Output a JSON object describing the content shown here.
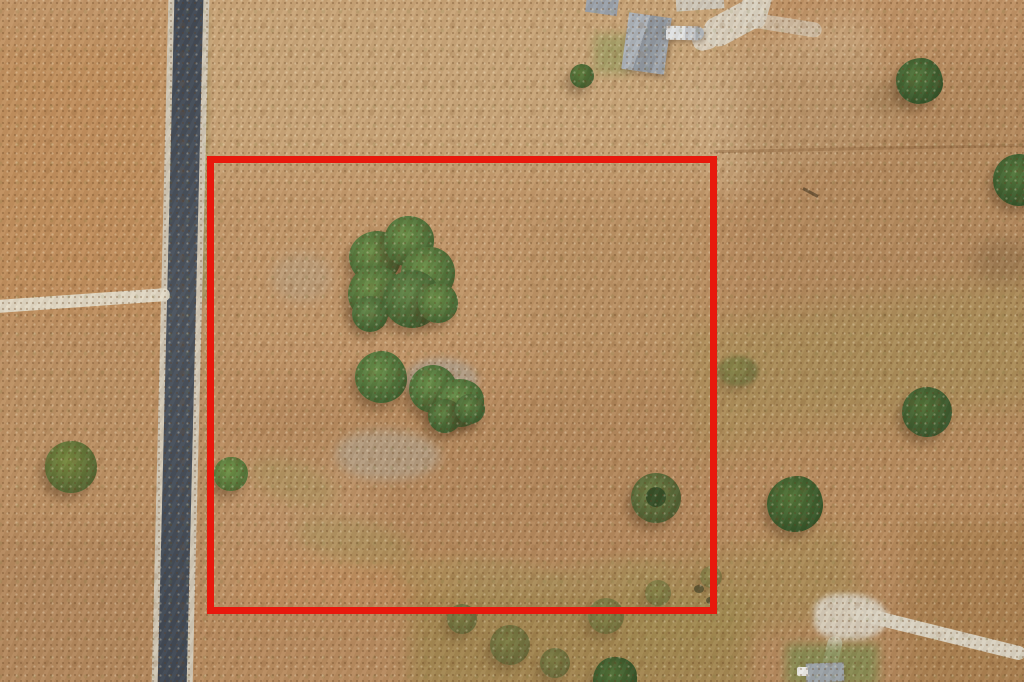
{
  "meta": {
    "type": "aerial-drone-photo",
    "subject": "vacant rural land parcel outlined with red property boundary, paved road on left, homestead with buildings at top, scattered trees and gravel drives"
  },
  "colors": {
    "boundary_red": "#e8190d",
    "road_asphalt": "#47505c",
    "road_shoulder": "#cfc6b5",
    "gravel": "#d9d2c2",
    "ground_tan": "#bc9065",
    "tree_green": "#4e7036",
    "roof_gray": "#99a1ab",
    "rv_white": "#dfe2e4"
  },
  "scene": {
    "layers": [
      {
        "n": "ground-patch-top-light",
        "x": 180,
        "y": -20,
        "w": 560,
        "h": 200,
        "c": "#cbaa7e",
        "op": 0.8,
        "bl": 22
      },
      {
        "n": "ground-patch-topright-mowed",
        "x": 690,
        "y": 40,
        "w": 200,
        "h": 130,
        "c": "#cdad85",
        "op": 0.75,
        "bl": 14,
        "rot": -20
      },
      {
        "n": "ground-patch-topleft-orange",
        "x": -20,
        "y": 40,
        "w": 190,
        "h": 280,
        "c": "#c08a54",
        "op": 0.5,
        "bl": 20
      },
      {
        "n": "ground-patch-left-mid",
        "x": -20,
        "y": 330,
        "w": 190,
        "h": 200,
        "c": "#bb9265",
        "op": 0.5,
        "bl": 20
      },
      {
        "n": "ground-patch-left-bottom",
        "x": -20,
        "y": 530,
        "w": 200,
        "h": 170,
        "c": "#ad835a",
        "op": 0.55,
        "bl": 18
      },
      {
        "n": "ground-patch-parcel-upper",
        "x": 220,
        "y": 165,
        "w": 490,
        "h": 210,
        "c": "#c49b6e",
        "op": 0.6,
        "bl": 22
      },
      {
        "n": "ground-patch-parcel-right-dark",
        "x": 530,
        "y": 200,
        "w": 190,
        "h": 230,
        "c": "#b18a5c",
        "op": 0.45,
        "bl": 24
      },
      {
        "n": "ground-patch-parcel-lower",
        "x": 235,
        "y": 395,
        "w": 470,
        "h": 215,
        "c": "#b0855a",
        "op": 0.5,
        "bl": 22
      },
      {
        "n": "ground-patch-parcel-left-light",
        "x": 222,
        "y": 455,
        "w": 150,
        "h": 150,
        "c": "#c59c72",
        "op": 0.5,
        "bl": 18
      },
      {
        "n": "ground-patch-parcel-bottom-orange",
        "x": 240,
        "y": 555,
        "w": 220,
        "h": 60,
        "c": "#c18a57",
        "op": 0.45,
        "bl": 12
      },
      {
        "n": "ground-patch-right-brushy",
        "x": 740,
        "y": 60,
        "w": 300,
        "h": 420,
        "c": "#ad855a",
        "op": 0.55,
        "bl": 20
      },
      {
        "n": "ground-patch-right-green-band",
        "x": 690,
        "y": 300,
        "w": 360,
        "h": 130,
        "c": "#a39156",
        "op": 0.5,
        "bl": 16,
        "rot": -9
      },
      {
        "n": "ground-patch-right-lower",
        "x": 750,
        "y": 420,
        "w": 290,
        "h": 160,
        "c": "#ba8e60",
        "op": 0.5,
        "bl": 20
      },
      {
        "n": "ground-patch-scrub-band",
        "x": 410,
        "y": 592,
        "w": 340,
        "h": 100,
        "c": "#968549",
        "op": 0.6,
        "bl": 10
      },
      {
        "n": "ground-patch-scrub-upright",
        "x": 620,
        "y": 548,
        "w": 240,
        "h": 90,
        "c": "#a08c52",
        "op": 0.5,
        "bl": 12,
        "rot": -12
      },
      {
        "n": "ground-patch-bottomright-brushy",
        "x": 905,
        "y": 520,
        "w": 140,
        "h": 180,
        "c": "#a37a49",
        "op": 0.6,
        "bl": 12
      },
      {
        "n": "rocky-patch",
        "x": 336,
        "y": 430,
        "w": 104,
        "h": 50,
        "c": "#b2a591",
        "op": 0.65,
        "bl": 5,
        "r": "45% 55% 50% 50%"
      },
      {
        "n": "rocky-patch",
        "x": 404,
        "y": 358,
        "w": 74,
        "h": 44,
        "c": "#aba294",
        "op": 0.7,
        "bl": 4,
        "r": "50%"
      },
      {
        "n": "rocky-patch",
        "x": 272,
        "y": 252,
        "w": 60,
        "h": 50,
        "c": "#b4a68e",
        "op": 0.4,
        "bl": 6,
        "r": "50%"
      },
      {
        "n": "swale-patch",
        "x": 248,
        "y": 462,
        "w": 90,
        "h": 40,
        "c": "#9f9358",
        "op": 0.4,
        "bl": 7,
        "rot": 20,
        "r": "50%"
      },
      {
        "n": "swale-patch",
        "x": 295,
        "y": 520,
        "w": 120,
        "h": 44,
        "c": "#9f9358",
        "op": 0.4,
        "bl": 7,
        "rot": 12,
        "r": "50%"
      },
      {
        "n": "swale-patch",
        "x": 395,
        "y": 558,
        "w": 170,
        "h": 40,
        "c": "#9f9358",
        "op": 0.4,
        "bl": 7,
        "rot": 3,
        "r": "50%"
      },
      {
        "n": "swale-patch",
        "x": 545,
        "y": 560,
        "w": 130,
        "h": 34,
        "c": "#9f9358",
        "op": 0.35,
        "bl": 7,
        "rot": -6,
        "r": "50%"
      },
      {
        "n": "roadside-grass-strip",
        "x": 196,
        "y": 10,
        "w": 12,
        "h": 290,
        "c": "#8d8d52",
        "op": 0.5,
        "bl": 3
      },
      {
        "n": "fence-line",
        "x": 714,
        "y": 147,
        "w": 310,
        "h": 3,
        "c": "rgba(145,105,65,0.5)",
        "rot": -1.2
      },
      {
        "n": "paved-road-shoulder",
        "x": 160,
        "y": -10,
        "w": 41,
        "h": 705,
        "c": "#cfc6b5",
        "rot": 1.4
      },
      {
        "n": "paved-road-asphalt",
        "x": 166,
        "y": -10,
        "w": 29,
        "h": 705,
        "bg": "linear-gradient(180deg,#3e4754,#49525e 45%,#3d4653)",
        "rot": 1.4
      },
      {
        "n": "gravel-driveway-left",
        "x": -6,
        "y": 294,
        "w": 176,
        "h": 13,
        "c": "#e2dbc9",
        "rot": -4,
        "r": 6,
        "op": 0.95
      },
      {
        "n": "gravel-driveway-top",
        "x": 741,
        "y": -12,
        "w": 28,
        "h": 40,
        "c": "#d9d2c2",
        "rot": 16,
        "r": 10,
        "op": 0.95
      },
      {
        "n": "gravel-driveway-top",
        "x": 702,
        "y": 8,
        "w": 64,
        "h": 30,
        "c": "#d9d2c2",
        "rot": -28,
        "r": 14,
        "op": 0.95
      },
      {
        "n": "gravel-driveway-top",
        "x": 692,
        "y": 28,
        "w": 26,
        "h": 22,
        "c": "#d9d2c2",
        "rot": -15,
        "r": 10,
        "op": 0.9
      },
      {
        "n": "gravel-driveway-top",
        "x": 752,
        "y": 18,
        "w": 70,
        "h": 15,
        "c": "#d4cdbd",
        "rot": 9,
        "r": 8,
        "op": 0.65
      },
      {
        "n": "gravel-pad",
        "x": 814,
        "y": 594,
        "w": 74,
        "h": 46,
        "c": "#d6cebe",
        "r": "40% 60% 55% 45%",
        "bl": 3,
        "op": 0.95
      },
      {
        "n": "gravel-road-bottomright",
        "x": 848,
        "y": 626,
        "w": 180,
        "h": 14,
        "c": "#d9d2c2",
        "rot": 13.9,
        "r": 7
      },
      {
        "n": "gravel-spur-bottom",
        "x": 824,
        "y": 636,
        "w": 15,
        "h": 42,
        "c": "#d8d1c1",
        "rot": 14,
        "r": 7,
        "op": 0.85
      },
      {
        "n": "lawn-patch-bottom",
        "x": 786,
        "y": 644,
        "w": 92,
        "h": 42,
        "c": "#7d8b50",
        "bl": 5,
        "op": 0.8
      },
      {
        "n": "shed-roof",
        "x": 806,
        "y": 663,
        "w": 38,
        "h": 19,
        "c": "#9aa2a8",
        "rot": -2,
        "sh": "1px 2px 4px rgba(70,50,30,.4)"
      },
      {
        "n": "vehicle-white",
        "x": 797,
        "y": 667,
        "w": 11,
        "h": 9,
        "c": "#e9e9e6",
        "r": 2
      },
      {
        "n": "lawn-patch-top",
        "x": 594,
        "y": 34,
        "w": 36,
        "h": 40,
        "c": "#8e9a5c",
        "bl": 5,
        "op": 0.6
      },
      {
        "n": "building-roof-small",
        "x": 586,
        "y": -4,
        "w": 32,
        "h": 18,
        "c": "#99a1ab",
        "rot": 8
      },
      {
        "n": "building-roof-partial",
        "x": 676,
        "y": -4,
        "w": 48,
        "h": 14,
        "c": "#cdc7ba",
        "rot": -4
      },
      {
        "n": "building-roof-main",
        "x": 625,
        "y": 15,
        "w": 43,
        "h": 57,
        "bg": "linear-gradient(100deg,#aab1ba 0 40%,#8e96a0 40% 75%,#9ba3ad 75%)",
        "rot": 8,
        "sh": "2px 3px 6px rgba(80,60,40,.4)"
      },
      {
        "n": "rv-trailer",
        "x": 662,
        "y": 26,
        "w": 42,
        "h": 14,
        "bg": "linear-gradient(90deg,#868d94 0 10%,#dfe2e4 10% 55%,#c6cacf 55% 80%,#aab0b6 80%)",
        "rot": 1,
        "r": 7,
        "sh": "1px 2px 4px rgba(80,60,40,.4)"
      },
      {
        "n": "tree-shadow",
        "x": 864,
        "y": 84,
        "w": 46,
        "h": 30,
        "c": "#96754e",
        "op": 0.5,
        "bl": 7,
        "r": "50%"
      },
      {
        "n": "tree-shadow",
        "x": 972,
        "y": 238,
        "w": 60,
        "h": 46,
        "c": "#8a6c48",
        "op": 0.5,
        "bl": 8,
        "r": "50%"
      },
      {
        "n": "tree-canopy",
        "x": 896,
        "y": 58,
        "w": 47,
        "h": 46,
        "c1": "#52773c",
        "c2": "#2f4e26",
        "r": "55% 45% 52% 48%/48% 55% 45% 52%"
      },
      {
        "n": "tree-canopy",
        "x": 993,
        "y": 154,
        "w": 52,
        "h": 52,
        "c1": "#52773c",
        "c2": "#2f4e26",
        "r": "50%"
      },
      {
        "n": "fallen-branch",
        "x": 802,
        "y": 191,
        "w": 17,
        "h": 3,
        "c": "#6d5537",
        "rot": 28
      },
      {
        "n": "tree-canopy-cluster",
        "x": 349,
        "y": 231,
        "w": 52,
        "c1": "#6b9049",
        "c2": "#3f6030",
        "r": "55% 45% 50% 50%/50% 52% 48% 50%"
      },
      {
        "n": "tree-canopy-cluster",
        "x": 384,
        "y": 216,
        "w": 50,
        "c1": "#6b9049",
        "c2": "#3f6030",
        "r": "48% 52% 55% 45%/52% 48% 50% 50%"
      },
      {
        "n": "tree-canopy-cluster",
        "x": 401,
        "y": 247,
        "w": 54,
        "c1": "#6b9049",
        "c2": "#3f6030",
        "r": "52% 48% 45% 55%/50% 50% 55% 45%"
      },
      {
        "n": "tree-canopy-cluster",
        "x": 348,
        "y": 266,
        "w": 54,
        "c1": "#6b9049",
        "c2": "#3f6030",
        "r": "50% 50% 52% 48%/55% 45% 50% 50%"
      },
      {
        "n": "tree-canopy-cluster",
        "x": 383,
        "y": 270,
        "w": 58,
        "c1": "#63884a",
        "c2": "#3a5a2c",
        "r": "50%"
      },
      {
        "n": "tree-canopy-cluster",
        "x": 418,
        "y": 283,
        "w": 40,
        "c1": "#6b9049",
        "c2": "#3f6030",
        "r": "55% 45% 50% 50%/48% 52% 50% 50%"
      },
      {
        "n": "tree-canopy-cluster",
        "x": 352,
        "y": 296,
        "w": 36,
        "c1": "#63884a",
        "c2": "#3a5a2c",
        "r": "50%"
      },
      {
        "n": "tree-canopy-cluster",
        "x": 355,
        "y": 351,
        "w": 52,
        "c1": "#68904a",
        "c2": "#3c5e2e",
        "r": "52% 48% 50% 50%/50% 55% 45% 50%"
      },
      {
        "n": "tree-canopy-cluster",
        "x": 409,
        "y": 365,
        "w": 48,
        "c1": "#68904a",
        "c2": "#3c5e2e",
        "r": "50%"
      },
      {
        "n": "tree-canopy-cluster",
        "x": 436,
        "y": 379,
        "w": 48,
        "c1": "#68904a",
        "c2": "#3c5e2e",
        "r": "48% 52% 50% 50%/55% 45% 52% 48%"
      },
      {
        "n": "tree-canopy-cluster",
        "x": 428,
        "y": 399,
        "w": 34,
        "c1": "#5f8444",
        "c2": "#38572b",
        "r": "50%"
      },
      {
        "n": "tree-canopy-cluster",
        "x": 455,
        "y": 394,
        "w": 30,
        "c1": "#5f8444",
        "c2": "#38572b",
        "r": "50%"
      },
      {
        "n": "tree-canopy",
        "x": 214,
        "y": 457,
        "w": 34,
        "c1": "#6f9348",
        "c2": "#4a6a33",
        "r": "52% 48% 50% 50%/50% 50% 55% 45%"
      },
      {
        "n": "tree-canopy",
        "x": 631,
        "y": 473,
        "w": 50,
        "c1": "#6e7f45",
        "c2": "#47582e",
        "r": "50%"
      },
      {
        "n": "tree-canopy-center",
        "x": 646,
        "y": 487,
        "w": 20,
        "c": "#2e4823",
        "r": "50%",
        "op": 0.9
      },
      {
        "n": "tree-canopy",
        "x": 45,
        "y": 441,
        "w": 52,
        "c1": "#77893f",
        "c2": "#4f6130",
        "r": "52% 48% 50% 50%/48% 52% 50% 50%"
      },
      {
        "n": "tree-canopy",
        "x": 767,
        "y": 476,
        "w": 56,
        "c1": "#527538",
        "c2": "#2f4f26",
        "r": "55% 45% 50% 50%/50% 52% 48% 50%"
      },
      {
        "n": "tree-canopy",
        "x": 902,
        "y": 387,
        "w": 50,
        "c1": "#4f7036",
        "c2": "#33512a",
        "r": "50%"
      },
      {
        "n": "tree-canopy",
        "x": 593,
        "y": 657,
        "w": 44,
        "c1": "#4e6f36",
        "c2": "#2f4c25",
        "r": "50% 50% 45% 55%/55% 45% 50% 50%"
      },
      {
        "n": "bush-small",
        "x": 570,
        "y": 64,
        "w": 24,
        "c1": "#5c7c3c",
        "c2": "#3b5a2c",
        "r": "50%"
      },
      {
        "n": "scrub-blob",
        "x": 447,
        "y": 604,
        "w": 30,
        "c1": "#6e7b40",
        "c2": "#4c5a2e",
        "r": "50%",
        "op": 0.7
      },
      {
        "n": "scrub-blob",
        "x": 490,
        "y": 625,
        "w": 40,
        "c1": "#6e7b40",
        "c2": "#4c5a2e",
        "r": "50%",
        "op": 0.7
      },
      {
        "n": "scrub-blob",
        "x": 540,
        "y": 648,
        "w": 30,
        "c1": "#6e7b40",
        "c2": "#4c5a2e",
        "r": "50%",
        "op": 0.7
      },
      {
        "n": "scrub-blob",
        "x": 588,
        "y": 598,
        "w": 36,
        "c1": "#72813f",
        "c2": "#4f5e2f",
        "r": "50%",
        "op": 0.6
      },
      {
        "n": "scrub-blob",
        "x": 645,
        "y": 580,
        "w": 26,
        "c1": "#72813f",
        "c2": "#4f5e2f",
        "r": "50%",
        "op": 0.55
      },
      {
        "n": "scrub-blob",
        "x": 700,
        "y": 566,
        "w": 22,
        "c1": "#72813f",
        "c2": "#4f5e2f",
        "r": "50%",
        "op": 0.5
      },
      {
        "n": "scrub-blob",
        "x": 718,
        "y": 356,
        "w": 40,
        "h": 30,
        "c1": "#72813f",
        "c2": "#4f5e2f",
        "r": "50%",
        "op": 0.6,
        "bl": 2
      },
      {
        "n": "scrub-speck",
        "x": 694,
        "y": 585,
        "w": 10,
        "h": 8,
        "c": "#4c4a2c",
        "op": 0.8,
        "r": "50%"
      },
      {
        "n": "scrub-speck",
        "x": 706,
        "y": 597,
        "w": 8,
        "h": 7,
        "c": "#4c4a2c",
        "op": 0.8,
        "r": "50%"
      },
      {
        "n": "property-boundary",
        "x": 207,
        "y": 156,
        "w": 510,
        "h": 458,
        "bd": "7px solid #e8190d",
        "z": 60
      }
    ]
  }
}
